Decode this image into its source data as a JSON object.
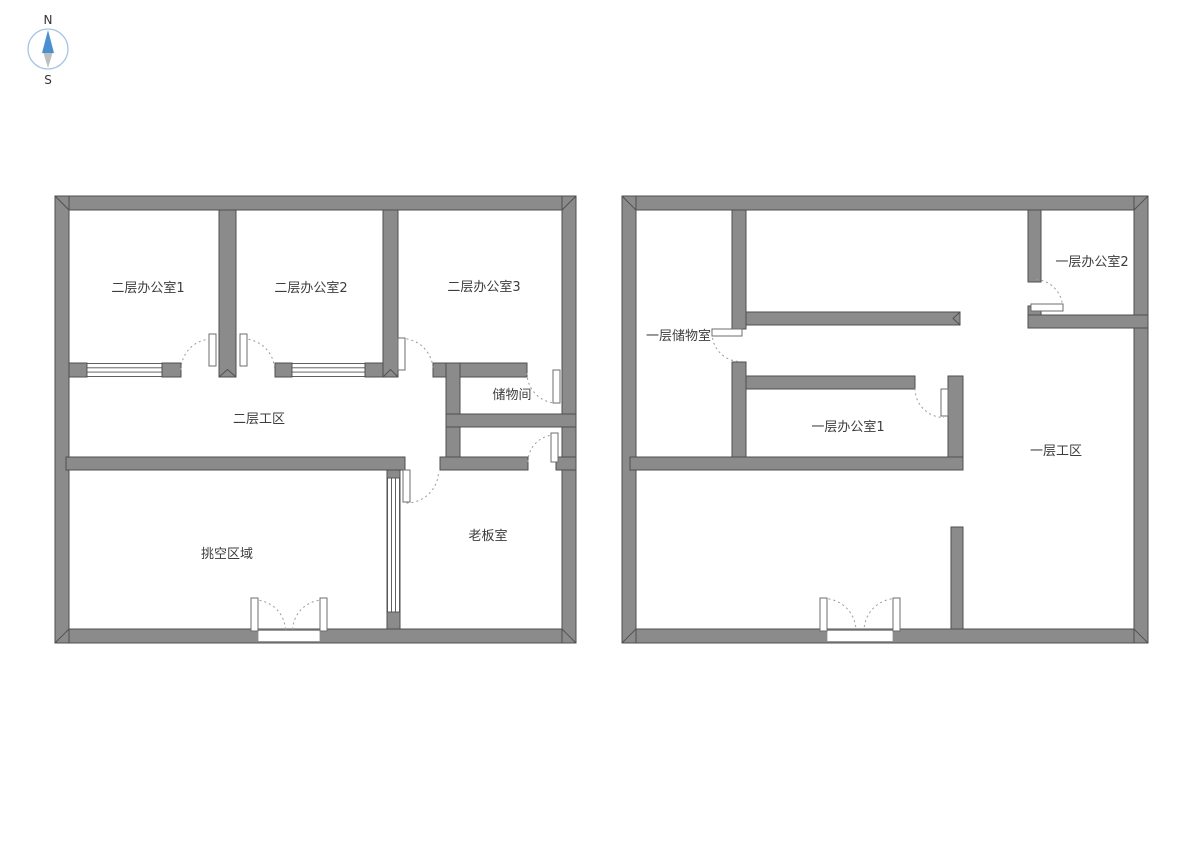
{
  "compass": {
    "north_label": "N",
    "south_label": "S"
  },
  "colors": {
    "background": "#ffffff",
    "wall_fill": "#8b8b8b",
    "wall_stroke": "#4f4f4f",
    "door_arc": "#9b9b9b",
    "text_color": "#3d3d3d",
    "compass_ring": "#a6c4e4",
    "compass_north": "#4a8fd0",
    "compass_south": "#bfbfbf"
  },
  "rooms": {
    "f2_office1": "二层办公室1",
    "f2_office2": "二层办公室2",
    "f2_office3": "二层办公室3",
    "f2_work": "二层工区",
    "f2_storage": "储物间",
    "f2_void": "挑空区域",
    "f2_boss": "老板室",
    "f1_storage": "一层储物室",
    "f1_office2": "一层办公室2",
    "f1_office1": "一层办公室1",
    "f1_work": "一层工区"
  }
}
